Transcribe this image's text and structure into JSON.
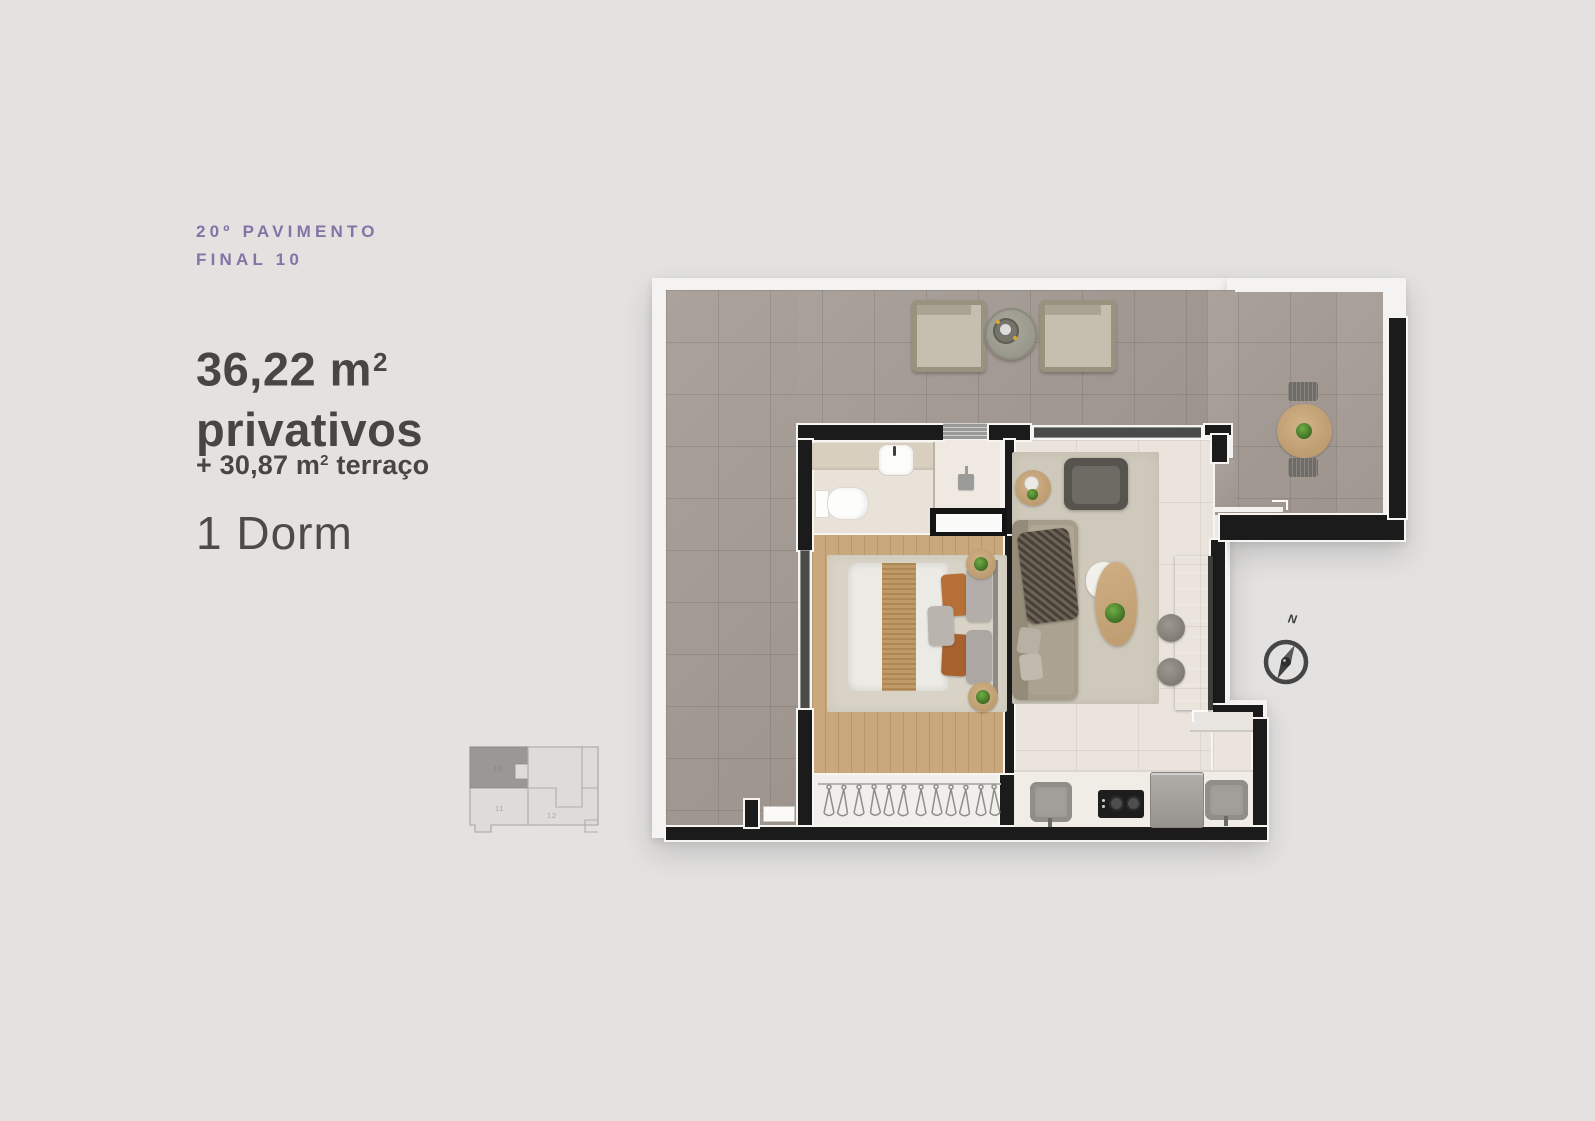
{
  "panel": {
    "floor_line1": "20º PAVIMENTO",
    "floor_line2": "FINAL 10",
    "area_value": "36,22 m",
    "area_sup": "2",
    "area_caption": "privativos",
    "terrace_prefix": "+ 30,87 m",
    "terrace_sup": "2",
    "terrace_suffix": " terraço",
    "dorm": "1 Dorm"
  },
  "keyplan": {
    "units": [
      {
        "id": "10",
        "highlighted": true
      },
      {
        "id": "11",
        "highlighted": false
      },
      {
        "id": "12",
        "highlighted": false
      }
    ]
  },
  "compass": {
    "north": "N"
  },
  "colors": {
    "background": "#e3e2e1",
    "accent_purple": "#8573a6",
    "text_dark": "#474645",
    "text_light": "#4c4b4a",
    "terrace_tile": "#a59c95",
    "interior_floor": "#eae4dd",
    "wood_floor": "#c9a87e",
    "wall": "#1b1b1b",
    "plant_green": "#477f2f",
    "keyplan_highlight": "#9b9795"
  }
}
